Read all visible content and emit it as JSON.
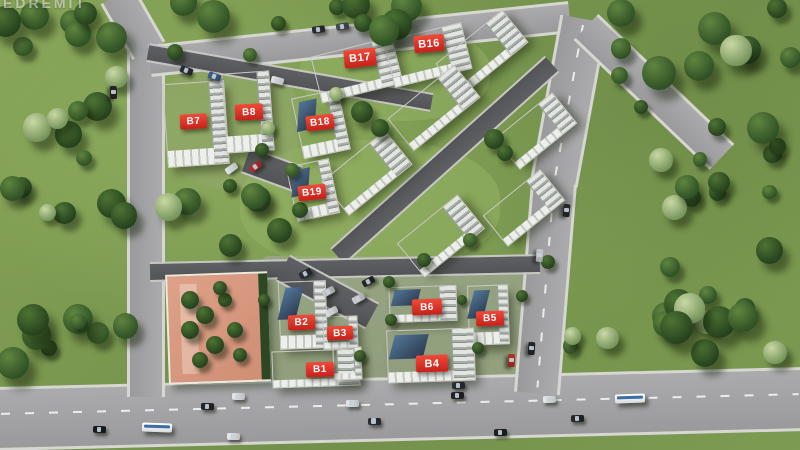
{
  "scene": {
    "width": 800,
    "height": 450,
    "watermark": "EDREMİT",
    "colors": {
      "label_red_top": "#f14a39",
      "label_red_bottom": "#c5211a",
      "road_gray": "#a2a2a4",
      "road_dark": "#58595d",
      "sidewalk": "#d6d6d2",
      "grass": "#7e9c51",
      "roof_white": "#f7f7f5",
      "glass_blue": "#334862",
      "courtyard_pink": "#d79a80",
      "bus_stripe_blue": "#3c6da6"
    }
  },
  "labels": [
    {
      "id": "B7",
      "text": "B7",
      "x": 193,
      "y": 121,
      "w": 27,
      "h": 15,
      "rot": -3,
      "fs": 10
    },
    {
      "id": "B8",
      "text": "B8",
      "x": 249,
      "y": 112,
      "w": 28,
      "h": 16,
      "rot": -3,
      "fs": 10
    },
    {
      "id": "B18",
      "text": "B18",
      "x": 320,
      "y": 122,
      "w": 28,
      "h": 15,
      "rot": -6,
      "fs": 10
    },
    {
      "id": "B19",
      "text": "B19",
      "x": 312,
      "y": 192,
      "w": 28,
      "h": 15,
      "rot": -6,
      "fs": 10
    },
    {
      "id": "B17",
      "text": "B17",
      "x": 360,
      "y": 58,
      "w": 32,
      "h": 18,
      "rot": -6,
      "fs": 11
    },
    {
      "id": "B16",
      "text": "B16",
      "x": 429,
      "y": 43,
      "w": 30,
      "h": 17,
      "rot": -5,
      "fs": 11
    },
    {
      "id": "B2",
      "text": "B2",
      "x": 301,
      "y": 322,
      "w": 27,
      "h": 15,
      "rot": -2,
      "fs": 10
    },
    {
      "id": "B3",
      "text": "B3",
      "x": 340,
      "y": 333,
      "w": 26,
      "h": 14,
      "rot": -2,
      "fs": 10
    },
    {
      "id": "B1",
      "text": "B1",
      "x": 320,
      "y": 369,
      "w": 28,
      "h": 15,
      "rot": -2,
      "fs": 10
    },
    {
      "id": "B6",
      "text": "B6",
      "x": 427,
      "y": 307,
      "w": 30,
      "h": 16,
      "rot": -2,
      "fs": 10
    },
    {
      "id": "B5",
      "text": "B5",
      "x": 490,
      "y": 318,
      "w": 28,
      "h": 15,
      "rot": -2,
      "fs": 10
    },
    {
      "id": "B4",
      "text": "B4",
      "x": 432,
      "y": 363,
      "w": 32,
      "h": 17,
      "rot": -2,
      "fs": 11
    }
  ],
  "buildings": [
    {
      "id": "b7",
      "cx": 196,
      "cy": 124,
      "w": 60,
      "h": 82,
      "rot": -4,
      "glass": false
    },
    {
      "id": "b8",
      "cx": 248,
      "cy": 112,
      "w": 46,
      "h": 78,
      "rot": -4,
      "glass": false
    },
    {
      "id": "b18",
      "cx": 321,
      "cy": 124,
      "w": 46,
      "h": 60,
      "rot": -12,
      "glass": true
    },
    {
      "id": "b19",
      "cx": 313,
      "cy": 190,
      "w": 42,
      "h": 54,
      "rot": -12,
      "glass": true
    },
    {
      "id": "b17",
      "cx": 357,
      "cy": 70,
      "w": 82,
      "h": 46,
      "rot": -14,
      "glass": false
    },
    {
      "id": "b16",
      "cx": 428,
      "cy": 55,
      "w": 78,
      "h": 46,
      "rot": -14,
      "glass": false
    },
    {
      "id": "m1",
      "cx": 482,
      "cy": 53,
      "w": 84,
      "h": 40,
      "rot": -39,
      "glass": false
    },
    {
      "id": "m2",
      "cx": 434,
      "cy": 108,
      "w": 84,
      "h": 40,
      "rot": -39,
      "glass": false
    },
    {
      "id": "m3",
      "cx": 367,
      "cy": 173,
      "w": 80,
      "h": 42,
      "rot": -39,
      "glass": false
    },
    {
      "id": "m4",
      "cx": 441,
      "cy": 236,
      "w": 76,
      "h": 42,
      "rot": -39,
      "glass": false
    },
    {
      "id": "m5",
      "cx": 536,
      "cy": 131,
      "w": 72,
      "h": 38,
      "rot": -39,
      "glass": false
    },
    {
      "id": "m6",
      "cx": 524,
      "cy": 208,
      "w": 72,
      "h": 38,
      "rot": -39,
      "glass": false
    },
    {
      "id": "b2",
      "cx": 303,
      "cy": 315,
      "w": 46,
      "h": 66,
      "rot": -2,
      "glass": true
    },
    {
      "id": "b3",
      "cx": 340,
      "cy": 332,
      "w": 33,
      "h": 31,
      "rot": -2,
      "glass": false
    },
    {
      "id": "b1",
      "cx": 316,
      "cy": 368,
      "w": 86,
      "h": 35,
      "rot": -2,
      "glass": false
    },
    {
      "id": "b1x",
      "cx": 347,
      "cy": 363,
      "w": 27,
      "h": 31,
      "rot": -2,
      "glass": false
    },
    {
      "id": "b6",
      "cx": 423,
      "cy": 304,
      "w": 66,
      "h": 34,
      "rot": -2,
      "glass": true
    },
    {
      "id": "b5",
      "cx": 488,
      "cy": 315,
      "w": 39,
      "h": 58,
      "rot": -2,
      "glass": true
    },
    {
      "id": "b4",
      "cx": 431,
      "cy": 355,
      "w": 86,
      "h": 51,
      "rot": -2,
      "glass": true
    }
  ],
  "roads": [
    {
      "id": "main-blvd",
      "x1": -5,
      "y1": 416,
      "x2": 805,
      "y2": 396,
      "w": 58,
      "cls": "light",
      "dash": true,
      "dashTop": "40%"
    },
    {
      "id": "left-street",
      "x1": 146,
      "y1": 44,
      "x2": 146,
      "y2": 394,
      "w": 32,
      "cls": "light",
      "dash": false
    },
    {
      "id": "left-street-entry",
      "x1": 117,
      "y1": -8,
      "x2": 149,
      "y2": 48,
      "w": 32,
      "cls": "light",
      "dash": false
    },
    {
      "id": "top-street",
      "x1": 150,
      "y1": 58,
      "x2": 570,
      "y2": 14,
      "w": 26,
      "cls": "light",
      "dash": false
    },
    {
      "id": "right-street-upper",
      "x1": 584,
      "y1": 16,
      "x2": 554,
      "y2": 180,
      "w": 42,
      "cls": "light",
      "dash": true,
      "dashTop": "48%"
    },
    {
      "id": "right-street-lower",
      "x1": 554,
      "y1": 180,
      "x2": 537,
      "y2": 390,
      "w": 40,
      "cls": "light",
      "dash": true,
      "dashTop": "48%"
    },
    {
      "id": "northeast-stub",
      "x1": 586,
      "y1": 24,
      "x2": 722,
      "y2": 154,
      "w": 30,
      "cls": "light",
      "dash": false
    },
    {
      "id": "inner-diagonal",
      "x1": 552,
      "y1": 62,
      "x2": 338,
      "y2": 254,
      "w": 18,
      "cls": "dark",
      "dash": false
    },
    {
      "id": "inner-north",
      "x1": 148,
      "y1": 50,
      "x2": 432,
      "y2": 100,
      "w": 15,
      "cls": "dark",
      "dash": false
    },
    {
      "id": "inner-cross",
      "x1": 150,
      "y1": 270,
      "x2": 540,
      "y2": 262,
      "w": 16,
      "cls": "dark",
      "dash": false
    },
    {
      "id": "b8-parking",
      "x1": 246,
      "y1": 158,
      "x2": 298,
      "y2": 177,
      "w": 24,
      "cls": "dark",
      "dash": false
    },
    {
      "id": "south-parking",
      "x1": 283,
      "y1": 266,
      "x2": 372,
      "y2": 314,
      "w": 26,
      "cls": "dark",
      "dash": false
    }
  ],
  "patches": [
    {
      "id": "south-cluster-paving",
      "x": 262,
      "y": 256,
      "w": 292,
      "h": 128,
      "color": "#a9aaa8",
      "opacity": 0.55,
      "round": "6px"
    },
    {
      "id": "central-lawn",
      "x": 240,
      "y": 140,
      "w": 260,
      "h": 130,
      "color": "#93b162",
      "opacity": 0.6,
      "round": "45%"
    },
    {
      "id": "north-lawn",
      "x": 300,
      "y": 26,
      "w": 190,
      "h": 95,
      "color": "#96b365",
      "opacity": 0.5,
      "round": "45%"
    },
    {
      "id": "west-lawn",
      "x": 160,
      "y": 58,
      "w": 140,
      "h": 130,
      "color": "#9aa878",
      "opacity": 0.35,
      "round": "45%"
    }
  ],
  "courtyard": {
    "id": "social-courtyard",
    "x": 167,
    "y": 273,
    "w": 98,
    "h": 106,
    "rot": -2
  },
  "vehicles": [
    {
      "type": "car",
      "x": 186,
      "y": 70,
      "rot": 20,
      "color": "#2a2d33"
    },
    {
      "type": "car",
      "x": 214,
      "y": 76,
      "rot": 20,
      "color": "#3f5d8c"
    },
    {
      "type": "car",
      "x": 277,
      "y": 80,
      "rot": 14,
      "color": "#e8e8ea"
    },
    {
      "type": "car",
      "x": 113,
      "y": 92,
      "rot": 88,
      "color": "#23262b"
    },
    {
      "type": "car",
      "x": 318,
      "y": 29,
      "rot": -8,
      "color": "#2a2d33"
    },
    {
      "type": "car",
      "x": 342,
      "y": 26,
      "rot": -8,
      "color": "#474c55"
    },
    {
      "type": "car",
      "x": 231,
      "y": 168,
      "rot": -35,
      "color": "#e8e8ea"
    },
    {
      "type": "car",
      "x": 255,
      "y": 166,
      "rot": -35,
      "color": "#b33030"
    },
    {
      "type": "car",
      "x": 566,
      "y": 210,
      "rot": 96,
      "color": "#23262b"
    },
    {
      "type": "car",
      "x": 539,
      "y": 255,
      "rot": 94,
      "color": "#c8cacd"
    },
    {
      "type": "car",
      "x": 531,
      "y": 348,
      "rot": 94,
      "color": "#23262b"
    },
    {
      "type": "car",
      "x": 511,
      "y": 360,
      "rot": 92,
      "color": "#b23026"
    },
    {
      "type": "car",
      "x": 305,
      "y": 273,
      "rot": -28,
      "color": "#2a2d33"
    },
    {
      "type": "car",
      "x": 328,
      "y": 291,
      "rot": -28,
      "color": "#c8cacd"
    },
    {
      "type": "car",
      "x": 358,
      "y": 298,
      "rot": -28,
      "color": "#cfd1d4"
    },
    {
      "type": "car",
      "x": 331,
      "y": 311,
      "rot": -28,
      "color": "#dfe1e3"
    },
    {
      "type": "car",
      "x": 368,
      "y": 281,
      "rot": -28,
      "color": "#23262b"
    },
    {
      "type": "car",
      "x": 458,
      "y": 385,
      "rot": -2,
      "color": "#2a2d33"
    },
    {
      "type": "car",
      "x": 99,
      "y": 429,
      "rot": 2,
      "color": "#1b1d21"
    },
    {
      "type": "bus",
      "x": 157,
      "y": 427,
      "rot": 2
    },
    {
      "type": "car",
      "x": 207,
      "y": 406,
      "rot": 1,
      "color": "#24262b"
    },
    {
      "type": "car",
      "x": 238,
      "y": 396,
      "rot": 1,
      "color": "#e9eaec"
    },
    {
      "type": "car",
      "x": 233,
      "y": 436,
      "rot": 1,
      "color": "#eceded"
    },
    {
      "type": "car",
      "x": 352,
      "y": 403,
      "rot": 0,
      "color": "#e9eaec"
    },
    {
      "type": "car",
      "x": 374,
      "y": 421,
      "rot": 0,
      "color": "#2b2e34"
    },
    {
      "type": "car",
      "x": 457,
      "y": 395,
      "rot": -1,
      "color": "#202227"
    },
    {
      "type": "car",
      "x": 500,
      "y": 432,
      "rot": -1,
      "color": "#1e2025"
    },
    {
      "type": "car",
      "x": 549,
      "y": 399,
      "rot": -1,
      "color": "#eceded"
    },
    {
      "type": "car",
      "x": 577,
      "y": 418,
      "rot": -1,
      "color": "#25272c"
    },
    {
      "type": "bus",
      "x": 630,
      "y": 398,
      "rot": -2
    }
  ],
  "trees": {
    "clusters": [
      {
        "x": 2,
        "y": 2,
        "w": 130,
        "h": 250,
        "n": 20,
        "seed": 11
      },
      {
        "x": 160,
        "y": 0,
        "w": 250,
        "h": 32,
        "n": 9,
        "seed": 23
      },
      {
        "x": 598,
        "y": 0,
        "w": 198,
        "h": 160,
        "n": 16,
        "seed": 37
      },
      {
        "x": 620,
        "y": 160,
        "w": 176,
        "h": 178,
        "n": 16,
        "seed": 41
      },
      {
        "x": 556,
        "y": 300,
        "w": 230,
        "h": 56,
        "n": 9,
        "seed": 53
      },
      {
        "x": 2,
        "y": 288,
        "w": 126,
        "h": 88,
        "n": 8,
        "seed": 67
      },
      {
        "x": 168,
        "y": 190,
        "w": 118,
        "h": 58,
        "n": 6,
        "seed": 71
      }
    ],
    "singles": [
      {
        "x": 362,
        "y": 112,
        "r": 11,
        "shade": "dark"
      },
      {
        "x": 380,
        "y": 128,
        "r": 9,
        "shade": "dark"
      },
      {
        "x": 494,
        "y": 139,
        "r": 10,
        "shade": "dark"
      },
      {
        "x": 505,
        "y": 153,
        "r": 8,
        "shade": "dark"
      },
      {
        "x": 300,
        "y": 210,
        "r": 8,
        "shade": "dark"
      },
      {
        "x": 336,
        "y": 94,
        "r": 7,
        "shade": "pale"
      },
      {
        "x": 262,
        "y": 150,
        "r": 7,
        "shade": "dark"
      },
      {
        "x": 292,
        "y": 170,
        "r": 7,
        "shade": "mid"
      },
      {
        "x": 389,
        "y": 282,
        "r": 6,
        "shade": "dark"
      },
      {
        "x": 391,
        "y": 320,
        "r": 6,
        "shade": "dark"
      },
      {
        "x": 462,
        "y": 300,
        "r": 5,
        "shade": "dark"
      },
      {
        "x": 478,
        "y": 348,
        "r": 6,
        "shade": "dark"
      },
      {
        "x": 522,
        "y": 296,
        "r": 6,
        "shade": "dark"
      },
      {
        "x": 548,
        "y": 262,
        "r": 7,
        "shade": "dark"
      },
      {
        "x": 360,
        "y": 356,
        "r": 6,
        "shade": "dark"
      },
      {
        "x": 264,
        "y": 300,
        "r": 6,
        "shade": "dark"
      },
      {
        "x": 424,
        "y": 260,
        "r": 7,
        "shade": "dark"
      },
      {
        "x": 470,
        "y": 240,
        "r": 7,
        "shade": "mid"
      },
      {
        "x": 230,
        "y": 186,
        "r": 7,
        "shade": "dark"
      },
      {
        "x": 268,
        "y": 128,
        "r": 7,
        "shade": "pale"
      },
      {
        "x": 175,
        "y": 52,
        "r": 8,
        "shade": "dark"
      },
      {
        "x": 250,
        "y": 55,
        "r": 7,
        "shade": "mid"
      }
    ],
    "courtyard_greens": [
      {
        "x": 190,
        "y": 300,
        "r": 9
      },
      {
        "x": 205,
        "y": 315,
        "r": 9
      },
      {
        "x": 190,
        "y": 330,
        "r": 9
      },
      {
        "x": 215,
        "y": 345,
        "r": 9
      },
      {
        "x": 200,
        "y": 360,
        "r": 8
      },
      {
        "x": 225,
        "y": 300,
        "r": 7
      },
      {
        "x": 235,
        "y": 330,
        "r": 8
      },
      {
        "x": 220,
        "y": 288,
        "r": 7
      },
      {
        "x": 240,
        "y": 355,
        "r": 7
      }
    ]
  }
}
